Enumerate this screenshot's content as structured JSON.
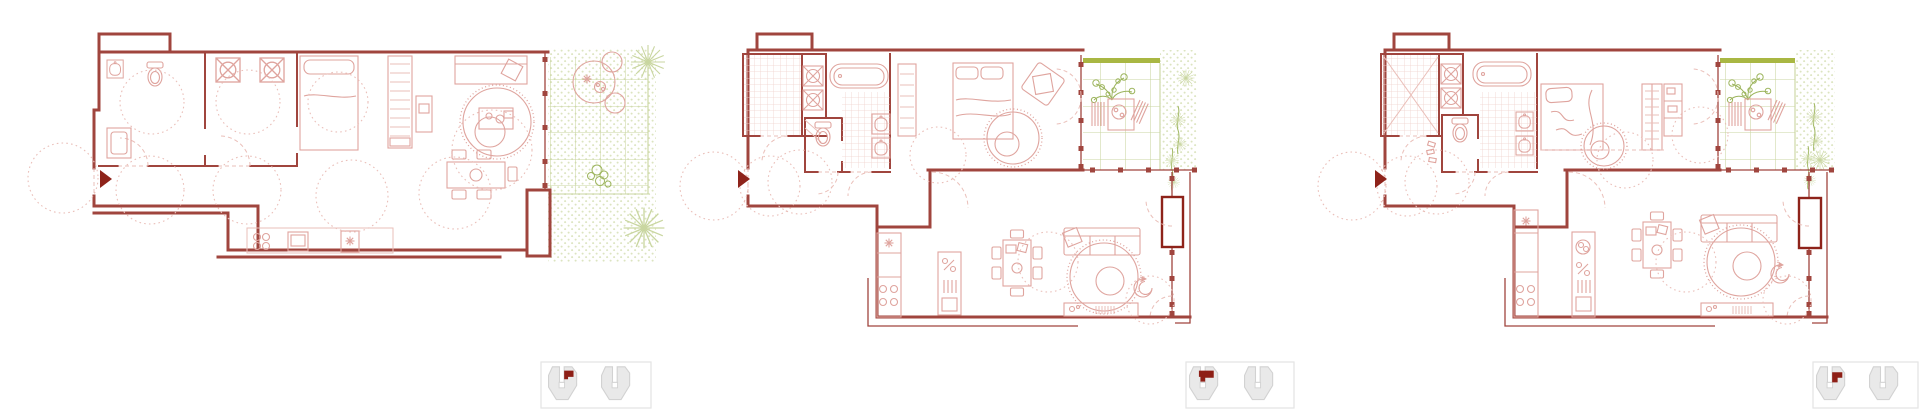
{
  "page": {
    "title": "Apartment floor plan variants",
    "background": "#ffffff"
  },
  "colors": {
    "wall": "#a0453e",
    "wall-dark": "#8e231a",
    "pink": "#dfa49e",
    "pink-light": "#eabfb9",
    "pink-faint": "#f0d2cd",
    "green": "#9cb45c",
    "green-grid": "#c9d6a0",
    "stipple": "#dce4c0",
    "olive": "#a9b743",
    "icon-fill": "#e9e9e9",
    "icon-stroke": "#d2d2d2",
    "icon-red": "#8e1f16",
    "icon-box": "#e3e3e3"
  },
  "plans": [
    {
      "id": "floor-plan-1",
      "aria": "Floor plan variant 1: apartment with bathroom, storage room, bedroom area, living-dining, kitchen and side garden with paved grid and planting"
    },
    {
      "id": "floor-plan-2",
      "aria": "Floor plan variant 2: apartment with shower room, bathroom, toilet, bedroom, wardrobe, kitchen island, living-dining and corner terrace with planting"
    },
    {
      "id": "floor-plan-3",
      "aria": "Floor plan variant 3: apartment with shower room, bathroom, toilet, bedroom with wardrobe wall, kitchen island, living-dining and corner terrace with planting"
    }
  ],
  "locators": [
    {
      "id": "unit-locator-1",
      "aria": "Building key plan, unit of variant 1 highlighted in red"
    },
    {
      "id": "unit-locator-2",
      "aria": "Building key plan, unit of variant 2 highlighted in red"
    },
    {
      "id": "unit-locator-3",
      "aria": "Building key plan, unit of variant 3 highlighted in red"
    }
  ]
}
